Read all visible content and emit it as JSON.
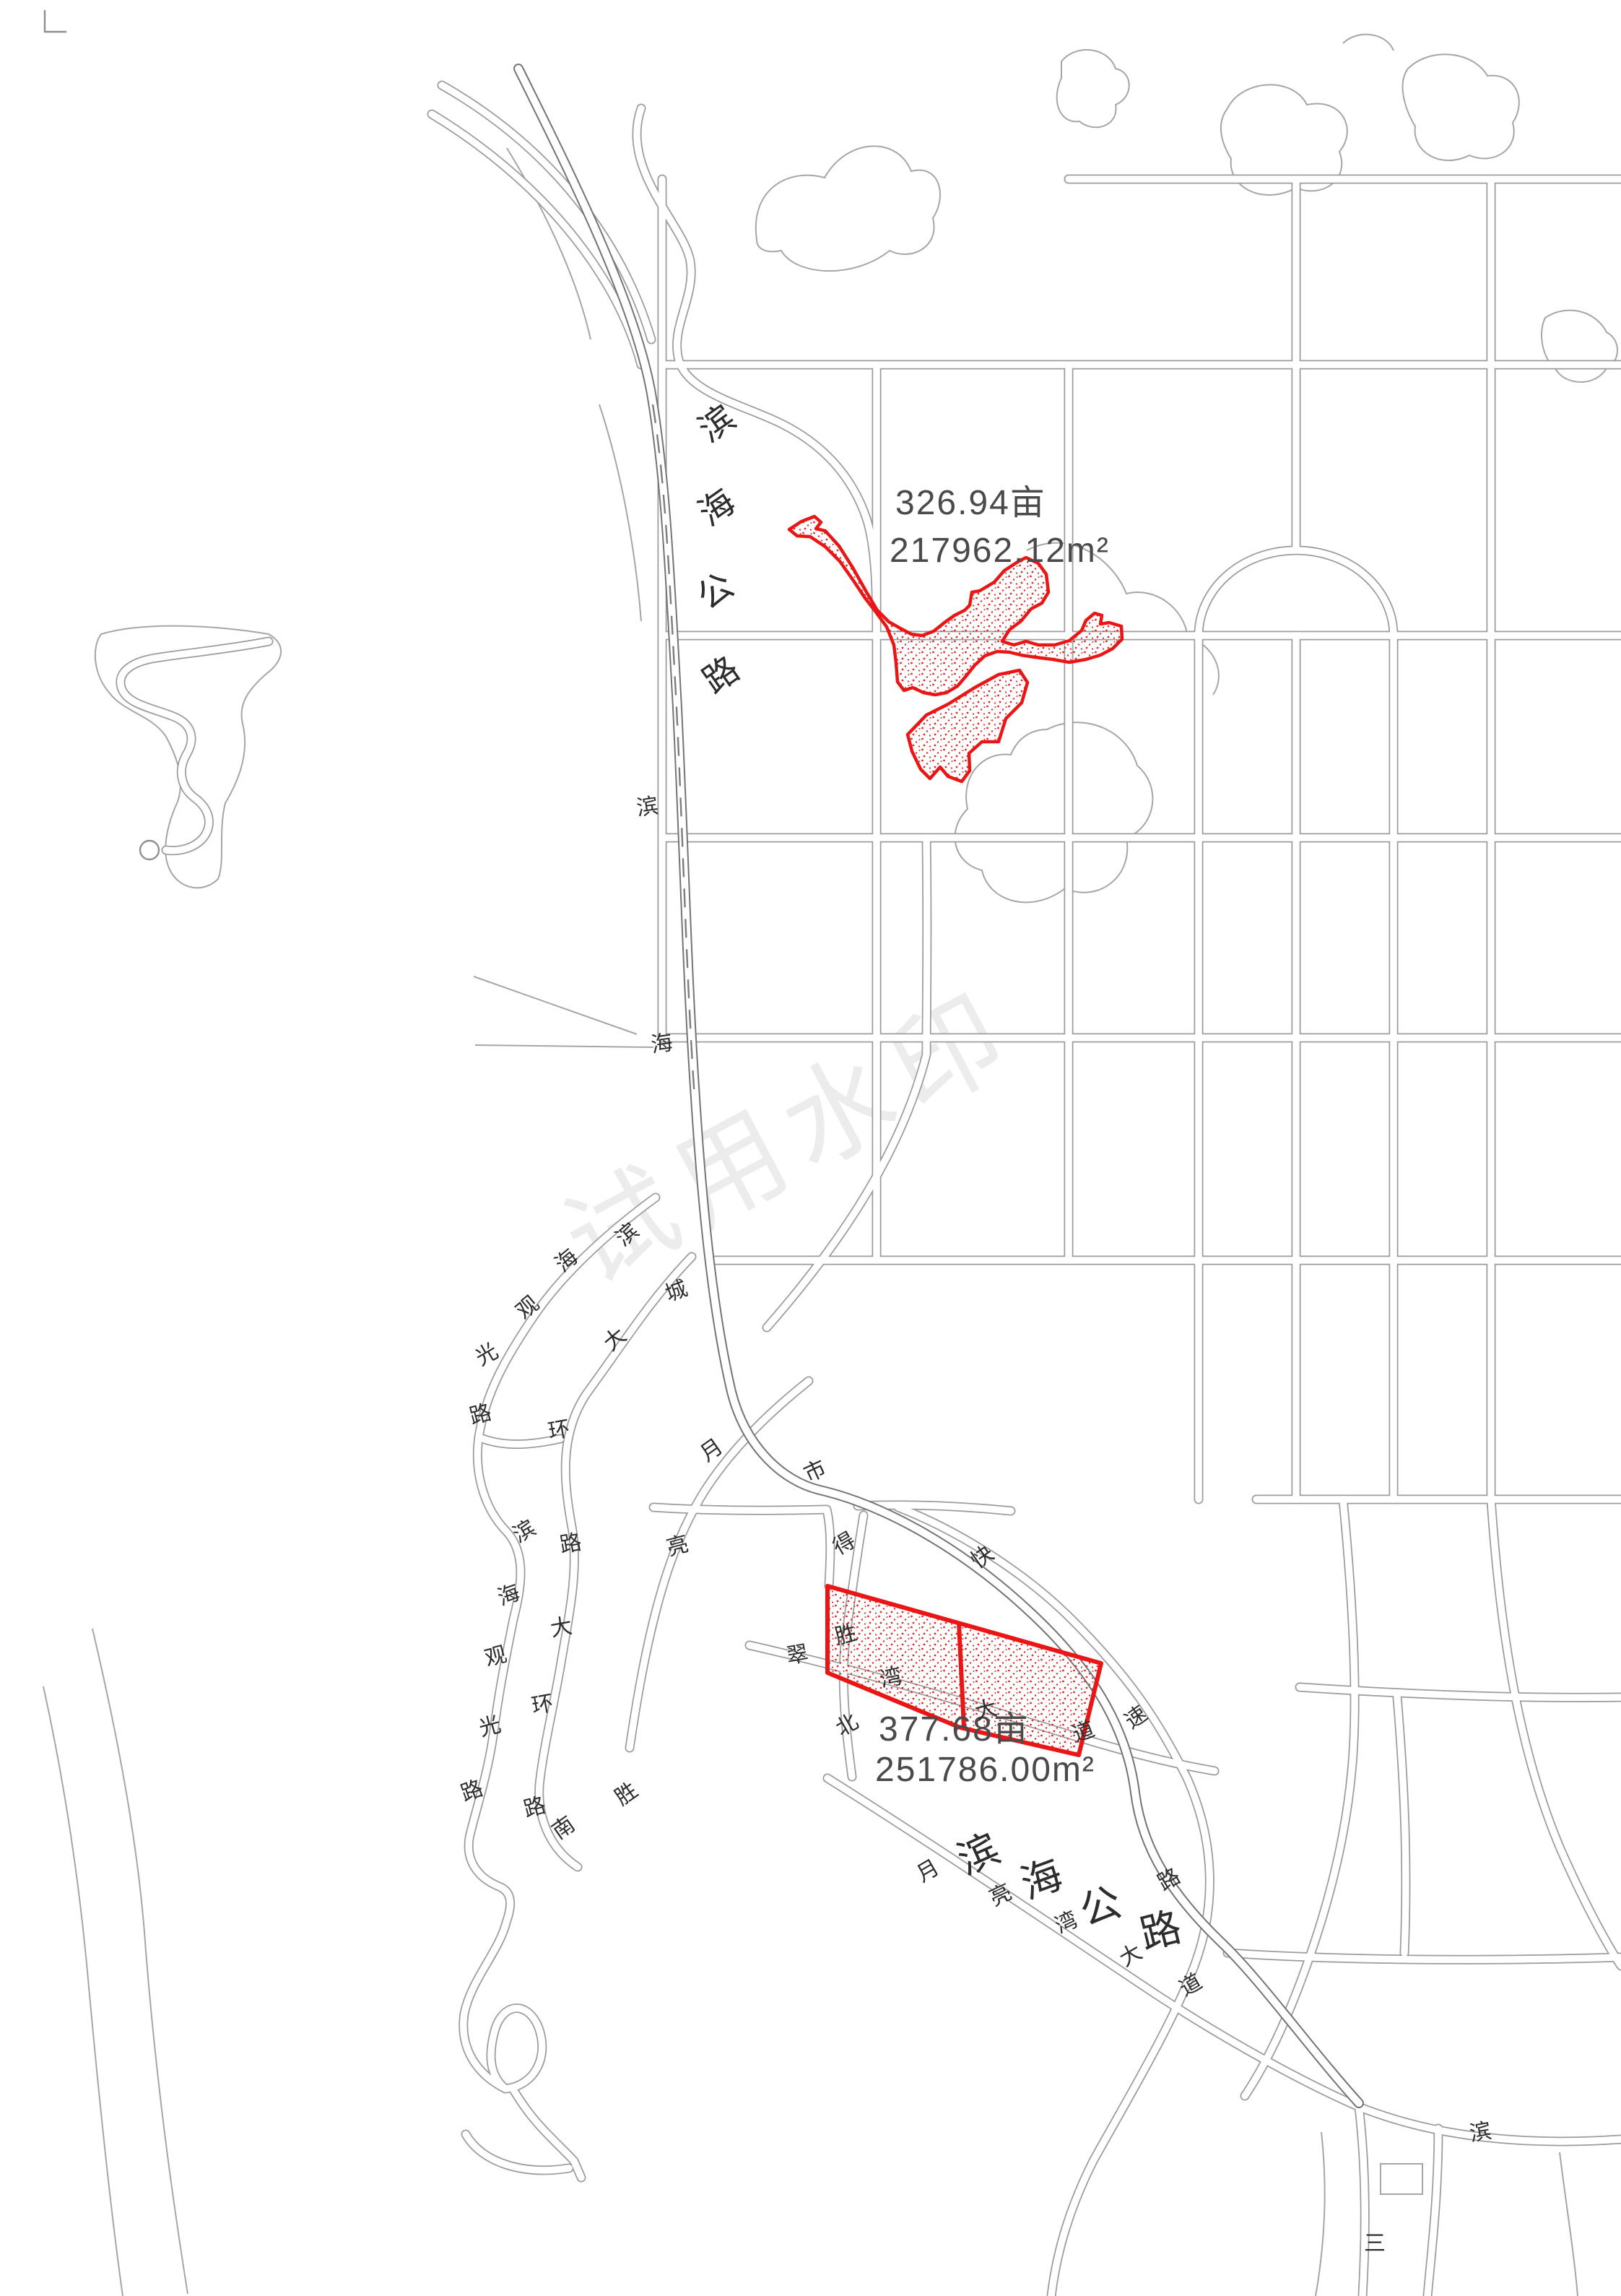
{
  "watermark": {
    "text": "试用水印"
  },
  "parcels": [
    {
      "name": "north-parcel",
      "area_mu": "326.94亩",
      "area_m2": "217962.12m²"
    },
    {
      "name": "south-parcel",
      "area_mu": "377.68亩",
      "area_m2": "251786.00m²"
    }
  ],
  "roads": {
    "binhai_highway_vertical": [
      "滨",
      "海",
      "公",
      "路"
    ],
    "binhai_highway_bottom": [
      "滨",
      "海",
      "公",
      "路"
    ],
    "labels": [
      "滨",
      "海",
      "城",
      "市",
      "滨",
      "海",
      "观",
      "光",
      "路",
      "大",
      "环",
      "滨",
      "路",
      "海",
      "大",
      "观",
      "环",
      "光",
      "路",
      "路",
      "南",
      "胜",
      "月",
      "亮",
      "得",
      "快",
      "速",
      "路",
      "胜",
      "翠",
      "湾",
      "大",
      "道",
      "北",
      "月",
      "亮",
      "湾",
      "大",
      "道",
      "滨",
      "三"
    ]
  },
  "colors": {
    "parcel_red": "#ea1515",
    "road_gray": "#9c9c9c",
    "highway_gray": "#747474",
    "label_ink": "#2e2e2e",
    "watermark_gray": "#ececec"
  }
}
